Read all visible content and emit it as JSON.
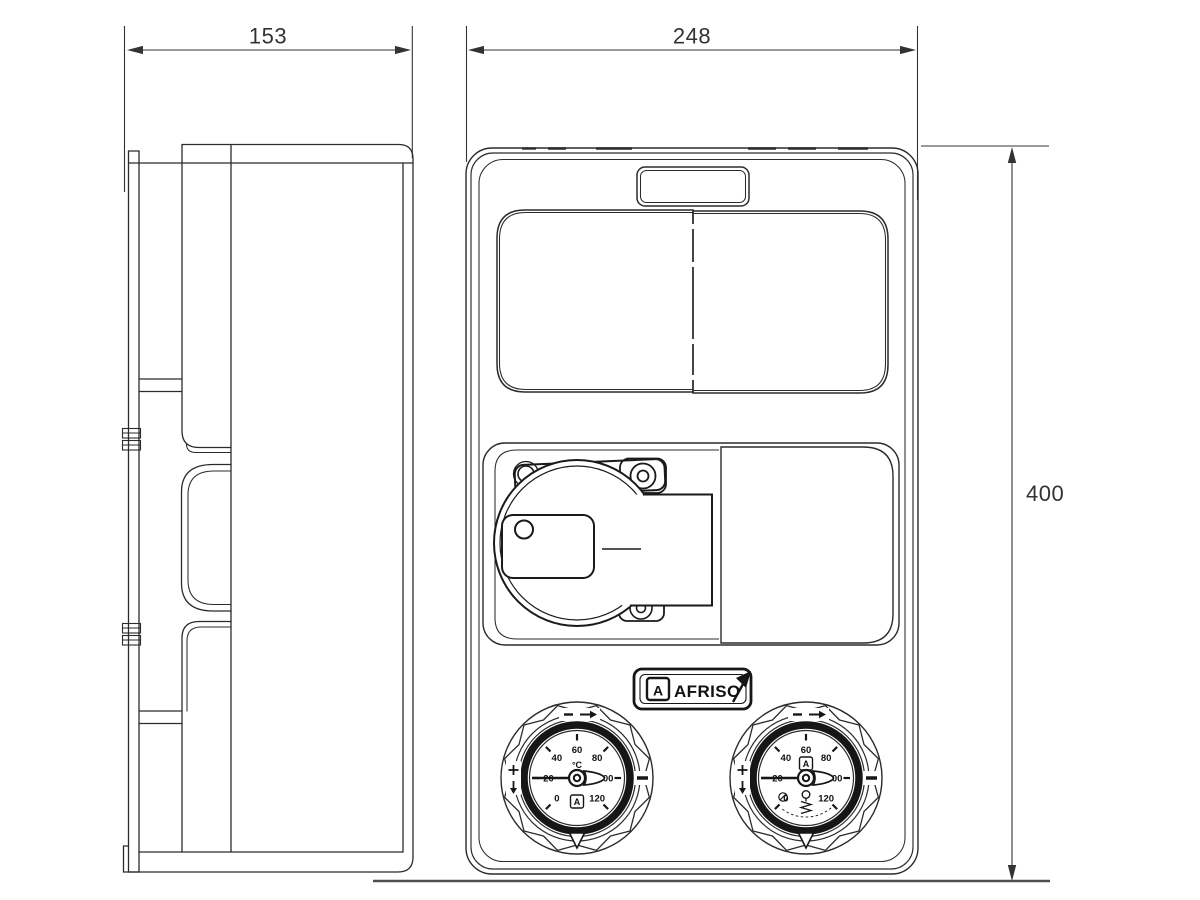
{
  "drawing": {
    "dimensions": {
      "depth": "153",
      "width": "248",
      "height": "400"
    },
    "brand": {
      "name": "AFRISO",
      "mark": "A"
    },
    "gauges": {
      "scale": [
        "0",
        "20",
        "40",
        "60",
        "80",
        "100",
        "120"
      ],
      "left": {
        "unit": "°C",
        "mark": "A"
      },
      "right": {
        "mark": "A"
      }
    },
    "colors": {
      "line": "#2b2b2b",
      "bold": "#161616",
      "dim": "#333333",
      "ground": "#4f4f4f",
      "bg": "#ffffff"
    }
  }
}
